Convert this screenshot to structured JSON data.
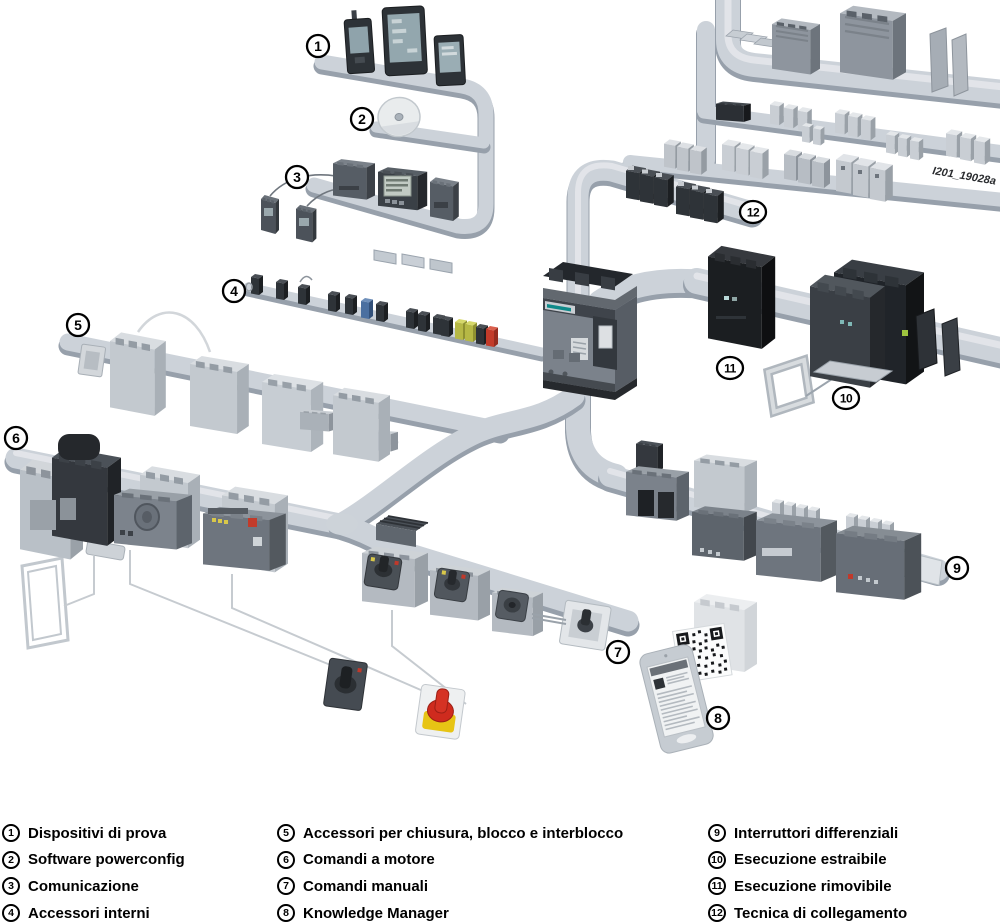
{
  "figure": {
    "watermark": "I201_19028a"
  },
  "legend": {
    "items": [
      {
        "n": "1",
        "label": "Dispositivi di prova"
      },
      {
        "n": "2",
        "label": "Software powerconfig"
      },
      {
        "n": "3",
        "label": "Comunicazione"
      },
      {
        "n": "4",
        "label": "Accessori interni"
      },
      {
        "n": "5",
        "label": "Accessori per chiusura, blocco e interblocco"
      },
      {
        "n": "6",
        "label": "Comandi a motore"
      },
      {
        "n": "7",
        "label": "Comandi manuali"
      },
      {
        "n": "8",
        "label": "Knowledge Manager"
      },
      {
        "n": "9",
        "label": "Interruttori differenziali"
      },
      {
        "n": "10",
        "label": "Esecuzione estraibile"
      },
      {
        "n": "11",
        "label": "Esecuzione rimovibile"
      },
      {
        "n": "12",
        "label": "Tecnica di collegamento"
      }
    ]
  }
}
